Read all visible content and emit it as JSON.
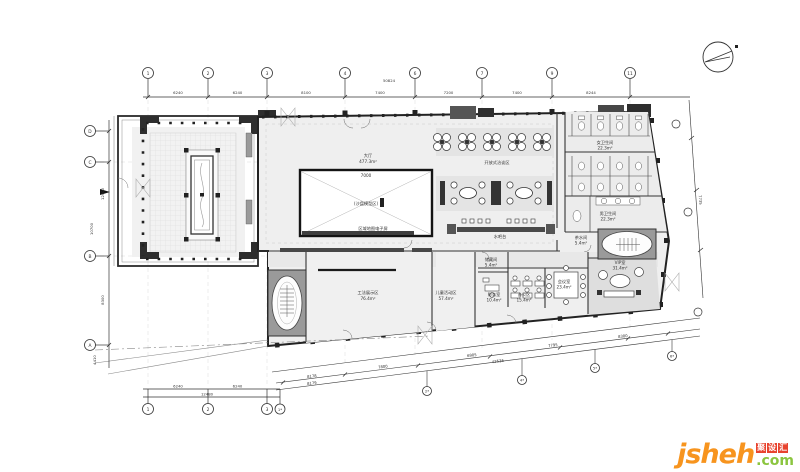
{
  "grid": {
    "top": {
      "total": "50824",
      "bubbles": [
        "1",
        "2",
        "3",
        "4",
        "6",
        "7",
        "9",
        "11"
      ],
      "dims": [
        "6240",
        "6240",
        "8100",
        "7400",
        "7200",
        "7400",
        "8244"
      ]
    },
    "left": {
      "bubbles": [
        "D",
        "C",
        "B",
        "A"
      ],
      "dims": [
        "12400",
        "10700",
        "8300",
        "4410"
      ]
    },
    "bottom": {
      "bubbles": [
        "1",
        "2",
        "3",
        "1*"
      ],
      "dims": [
        "6240",
        "6240"
      ],
      "total": "12480"
    },
    "incline": {
      "bubbles": [
        "2*",
        "4*",
        "5*",
        "6*"
      ],
      "dims": [
        "8178",
        "8179",
        "7800",
        "6905",
        "7795",
        "8300"
      ],
      "total": "42536"
    },
    "right": {
      "dims": [
        "7735"
      ]
    }
  },
  "rooms": {
    "hall": {
      "name": "大厅",
      "area": "477.3m²"
    },
    "sand_table": {
      "dim": "7000",
      "name": "(沙盘模型区)"
    },
    "screen_wall": {
      "name": "区域地图电子屏"
    },
    "open_lounge": {
      "name": "开放式洽谈区"
    },
    "water_bar": {
      "name": "水吧台"
    },
    "wc_women": {
      "name": "女卫生间",
      "area": "22.3m²"
    },
    "wc_men": {
      "name": "男卫生间",
      "area": "22.3m²"
    },
    "pantry": {
      "name": "茶水间",
      "area": "5.4m²"
    },
    "storage": {
      "name": "储藏间",
      "area": "5.4m²"
    },
    "vip": {
      "name": "VIP室",
      "area": "31.4m²"
    },
    "meeting": {
      "name": "会议室",
      "area": "23.4m²"
    },
    "office": {
      "name": "办公区",
      "area": "15.4m²"
    },
    "finance": {
      "name": "财务室",
      "area": "10.4m²"
    },
    "craft": {
      "name": "工法展示区",
      "area": "76.4m²"
    },
    "kids": {
      "name": "儿童活动区",
      "area": "57.4m²"
    }
  },
  "watermark": {
    "brand": "jsheh",
    "cn": [
      "聚",
      "设",
      "汇"
    ],
    "com": ".com",
    "colors": {
      "orange": "#f7941e",
      "red": "#e8432e",
      "green": "#8bc53f"
    }
  }
}
